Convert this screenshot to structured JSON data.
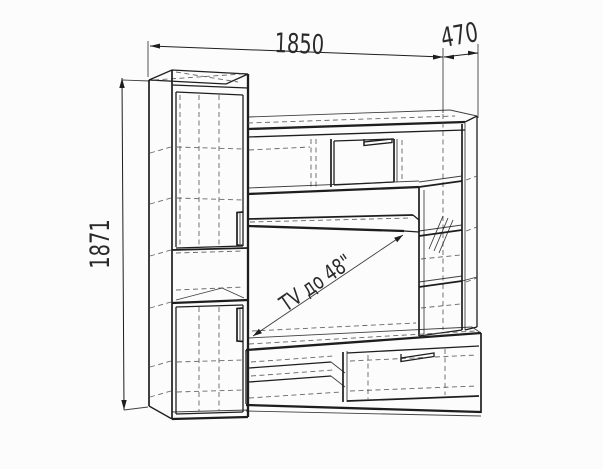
{
  "drawing": {
    "background": "#fcfcfc",
    "stroke_color": "#1e1e1e",
    "hidden_line_color": "#555555",
    "text_color": "#2a2a2a",
    "dimensions": {
      "width": "1850",
      "depth": "470",
      "height": "1871"
    },
    "tv_label": "TV до 48\""
  }
}
